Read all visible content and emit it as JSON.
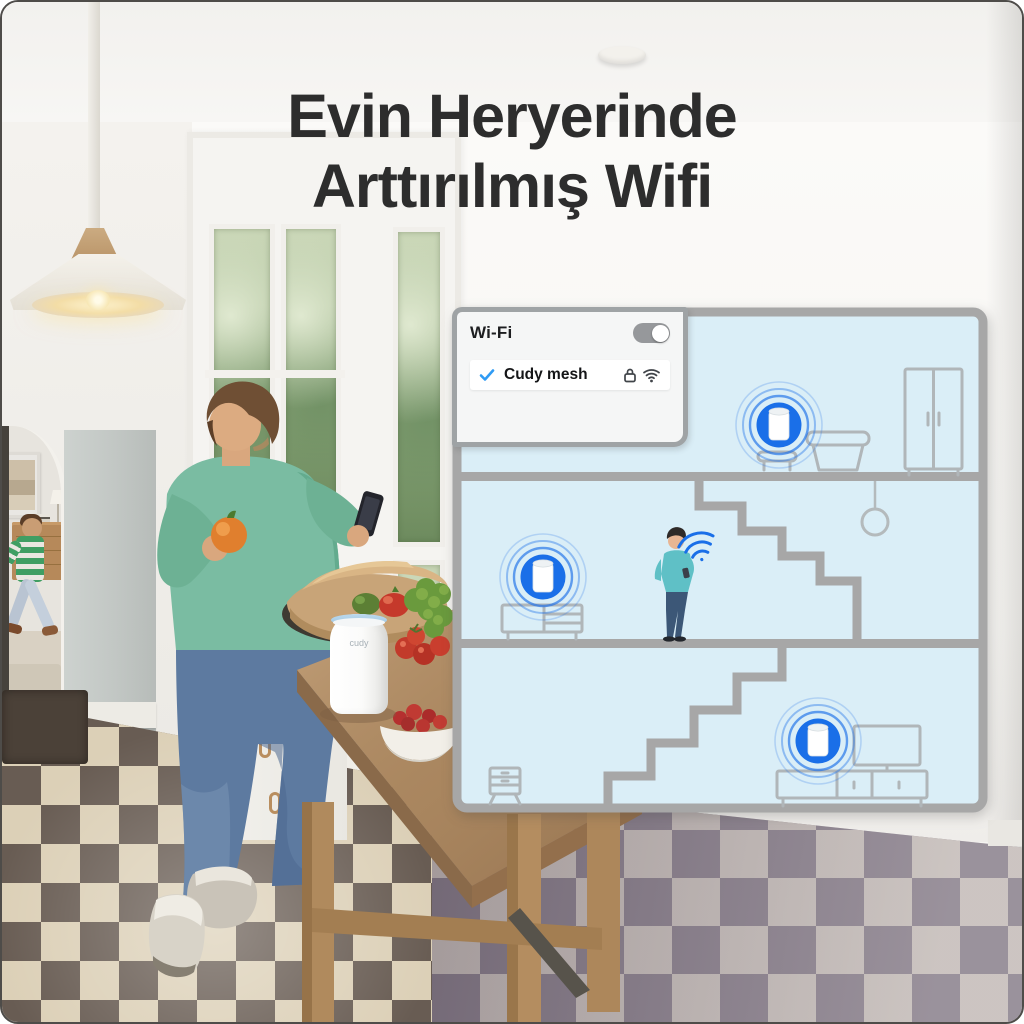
{
  "title": {
    "line1": "Evin Heryerinde",
    "line2": "Arttırılmış Wifi"
  },
  "wifi_card": {
    "title": "Wi-Fi",
    "toggle_state": "on",
    "network": {
      "name": "Cudy mesh",
      "selected": true,
      "secured": true,
      "selected_icon": "check-icon",
      "security_icon": "lock-icon",
      "signal_icon": "wifi-icon"
    }
  },
  "photo": {
    "router_brand_label": "cudy"
  },
  "colors": {
    "accent_blue": "#1a6fe8",
    "diagram_bg": "#daeef7",
    "diagram_frame": "#a7a7a7",
    "card_bg": "#f5f6f6",
    "toggle_track": "#96989b",
    "title_text": "#2d2d2d"
  }
}
